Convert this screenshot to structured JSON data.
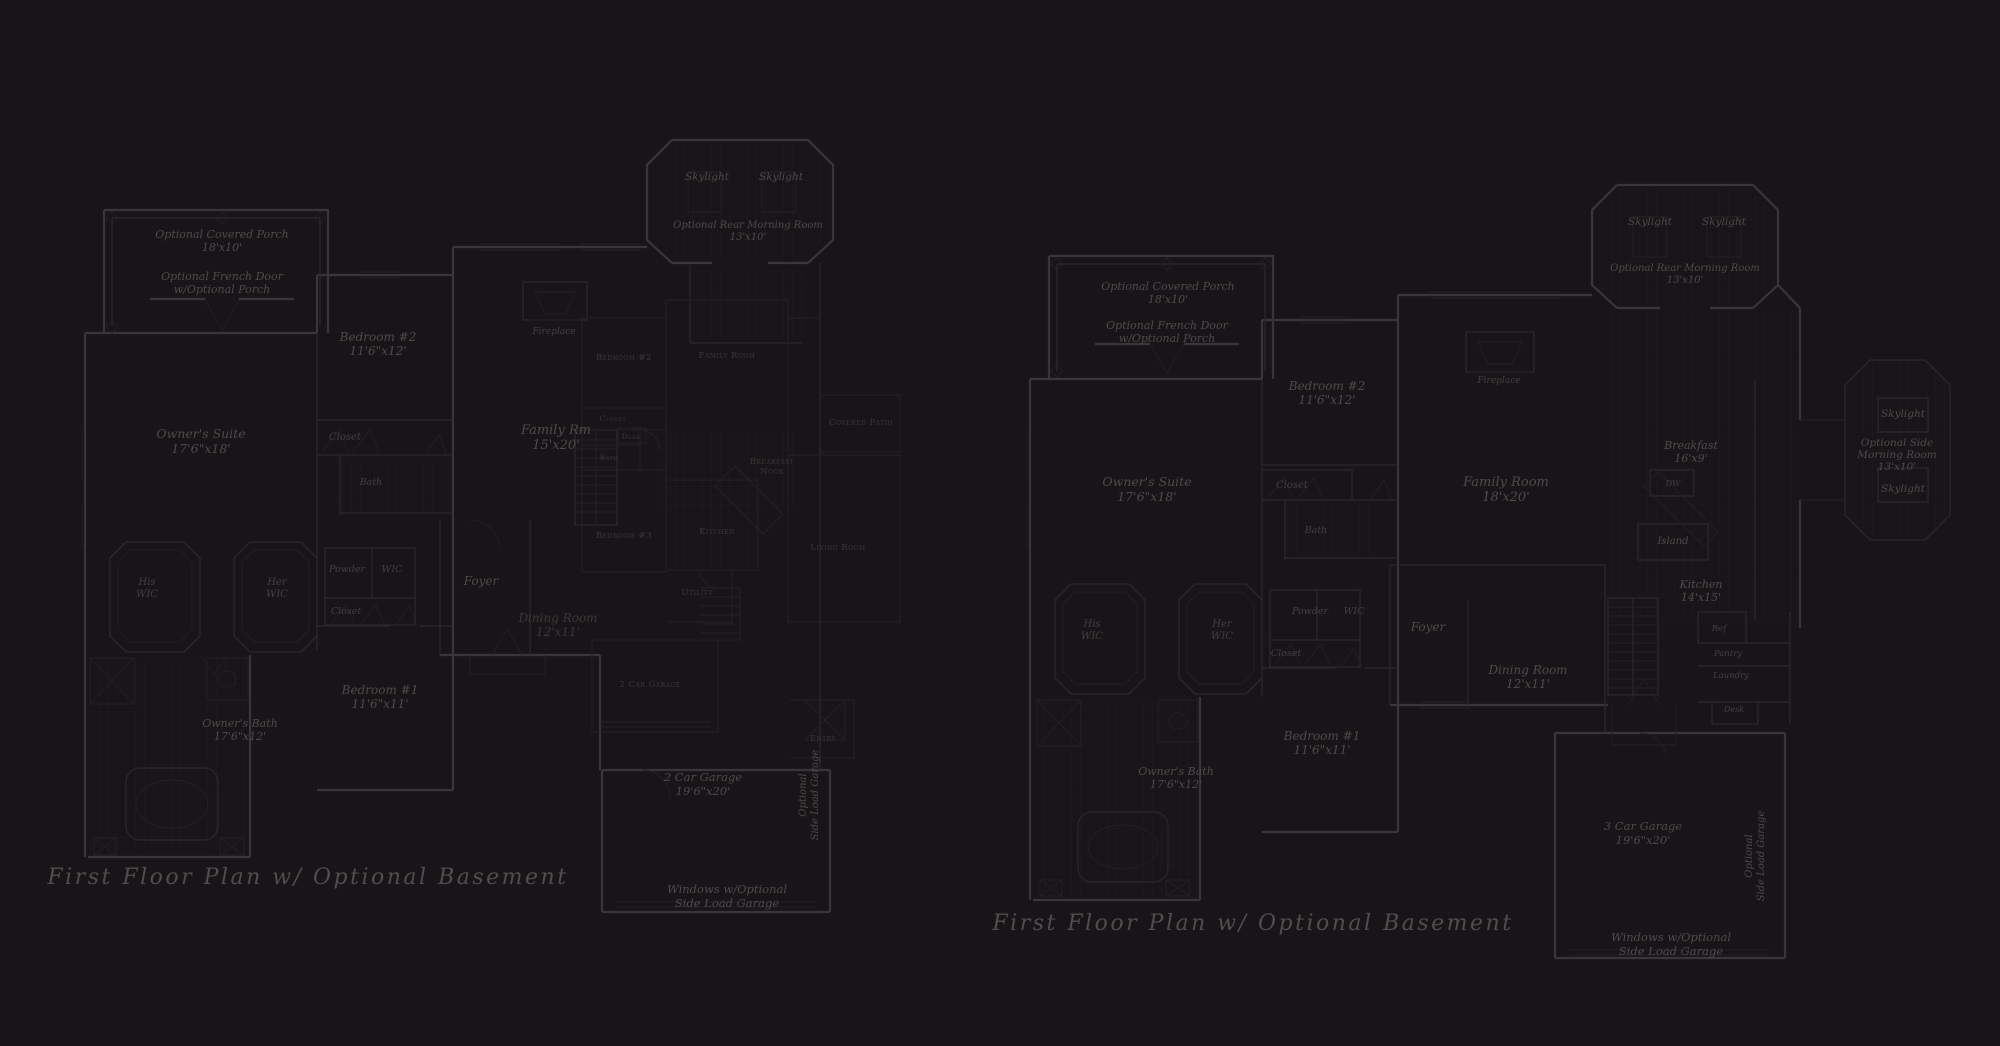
{
  "palette": {
    "background": "#181518",
    "wall_strong": "#39353a",
    "wall_medium": "#2b282c",
    "wall_thin": "#232024",
    "tile": "#201d21",
    "overlay_line": "#242124",
    "main": "#4e4a4b",
    "dim": "#443f41",
    "faint": "#3b3739",
    "caption": "#514c4d"
  },
  "captions": {
    "left": "First Floor Plan w/ Optional Basement",
    "right": "First Floor Plan w/ Optional Basement"
  },
  "labels": [
    {
      "name": "left-optional-covered-porch",
      "x": 222,
      "y": 238,
      "size": 11,
      "color": "main",
      "lines": [
        "Optional Covered Porch",
        "18'x10'"
      ]
    },
    {
      "name": "left-optional-french-door",
      "x": 222,
      "y": 280,
      "size": 11,
      "color": "main",
      "lines": [
        "Optional French Door",
        "w/Optional Porch"
      ]
    },
    {
      "name": "left-owners-suite",
      "x": 201,
      "y": 438,
      "size": 12.5,
      "color": "main",
      "lines": [
        "Owner's Suite",
        "17'6\"x18'"
      ]
    },
    {
      "name": "left-bedroom-2",
      "x": 378,
      "y": 341,
      "size": 12,
      "color": "main",
      "lines": [
        "Bedroom #2",
        "11'6\"x12'"
      ]
    },
    {
      "name": "left-closet-bedroom2",
      "x": 345,
      "y": 440,
      "size": 10,
      "color": "dim",
      "lines": [
        "Closet"
      ]
    },
    {
      "name": "left-bath",
      "x": 371,
      "y": 485,
      "size": 9.5,
      "color": "dim",
      "lines": [
        "Bath"
      ]
    },
    {
      "name": "left-his-wic",
      "x": 147,
      "y": 585,
      "size": 10,
      "color": "dim",
      "lines": [
        "His",
        "WIC"
      ]
    },
    {
      "name": "left-her-wic",
      "x": 277,
      "y": 585,
      "size": 10,
      "color": "dim",
      "lines": [
        "Her",
        "WIC"
      ]
    },
    {
      "name": "left-powder",
      "x": 347,
      "y": 572,
      "size": 9.5,
      "color": "dim",
      "lines": [
        "Powder"
      ]
    },
    {
      "name": "left-wic",
      "x": 392,
      "y": 572,
      "size": 9.5,
      "color": "dim",
      "lines": [
        "WIC"
      ]
    },
    {
      "name": "left-closet-hall",
      "x": 346,
      "y": 614,
      "size": 9.5,
      "color": "dim",
      "lines": [
        "Closet"
      ]
    },
    {
      "name": "left-bedroom-1",
      "x": 380,
      "y": 694,
      "size": 12,
      "color": "main",
      "lines": [
        "Bedroom #1",
        "11'6\"x11'"
      ]
    },
    {
      "name": "left-owners-bath",
      "x": 240,
      "y": 727,
      "size": 11,
      "color": "main",
      "lines": [
        "Owner's Bath",
        "17'6\"x12'"
      ]
    },
    {
      "name": "left-family-rm",
      "x": 556,
      "y": 434,
      "size": 13,
      "color": "main",
      "lines": [
        "Family Rm",
        "15'x20'"
      ]
    },
    {
      "name": "left-foyer",
      "x": 481,
      "y": 585,
      "size": 12,
      "color": "main",
      "lines": [
        "Foyer"
      ]
    },
    {
      "name": "left-dining",
      "x": 558,
      "y": 622,
      "size": 12,
      "color": "faint",
      "lines": [
        "Dining Room",
        "12'x11'"
      ]
    },
    {
      "name": "left-skylight-1",
      "x": 707,
      "y": 180,
      "size": 10.5,
      "color": "main",
      "lines": [
        "Skylight"
      ]
    },
    {
      "name": "left-skylight-2",
      "x": 781,
      "y": 180,
      "size": 10.5,
      "color": "main",
      "lines": [
        "Skylight"
      ]
    },
    {
      "name": "left-rear-morning-room",
      "x": 748,
      "y": 228,
      "size": 10,
      "color": "main",
      "lines": [
        "Optional Rear Morning Room",
        "13'x10'"
      ]
    },
    {
      "name": "left-fireplace",
      "x": 554,
      "y": 334,
      "size": 9,
      "color": "dim",
      "lines": [
        "Fireplace"
      ]
    },
    {
      "name": "left-2-car-garage",
      "x": 703,
      "y": 781,
      "size": 11.5,
      "color": "main",
      "lines": [
        "2 Car Garage",
        "19'6\"x20'"
      ]
    },
    {
      "name": "left-optional-side-load-garage",
      "x": 806,
      "y": 795,
      "size": 10,
      "color": "main",
      "rotate": -90,
      "lines": [
        "Optional",
        "Side Load Garage"
      ]
    },
    {
      "name": "left-windows-side-load",
      "x": 727,
      "y": 893,
      "size": 11.5,
      "color": "main",
      "lines": [
        "Windows w/Optional",
        "Side Load Garage"
      ]
    },
    {
      "name": "left-caption",
      "x": 308,
      "y": 884,
      "size": 22,
      "color": "caption",
      "cap": true,
      "lines": [
        "First Floor Plan w/ Optional Basement"
      ]
    },
    {
      "name": "overlay-bedroom-2",
      "x": 624,
      "y": 360,
      "size": 8.5,
      "color": "faint",
      "sc": true,
      "lines": [
        "Bedroom #2"
      ]
    },
    {
      "name": "overlay-family-room",
      "x": 727,
      "y": 358,
      "size": 8.5,
      "color": "faint",
      "sc": true,
      "lines": [
        "Family Room"
      ]
    },
    {
      "name": "overlay-closet",
      "x": 613,
      "y": 421,
      "size": 7.5,
      "color": "faint",
      "sc": true,
      "lines": [
        "Closet"
      ]
    },
    {
      "name": "overlay-desk",
      "x": 631,
      "y": 439,
      "size": 7.5,
      "color": "faint",
      "sc": true,
      "lines": [
        "Desk"
      ]
    },
    {
      "name": "overlay-bath",
      "x": 609,
      "y": 460,
      "size": 7.5,
      "color": "faint",
      "sc": true,
      "lines": [
        "Bath"
      ]
    },
    {
      "name": "overlay-bedroom-3",
      "x": 624,
      "y": 538,
      "size": 8.5,
      "color": "faint",
      "sc": true,
      "lines": [
        "Bedroom #3"
      ]
    },
    {
      "name": "overlay-breakfast-nook",
      "x": 772,
      "y": 464,
      "size": 8.5,
      "color": "faint",
      "sc": true,
      "lines": [
        "Breakfast",
        "Nook"
      ]
    },
    {
      "name": "overlay-kitchen",
      "x": 717,
      "y": 534,
      "size": 8.5,
      "color": "faint",
      "sc": true,
      "lines": [
        "Kitchen"
      ]
    },
    {
      "name": "overlay-living-room",
      "x": 838,
      "y": 550,
      "size": 8.5,
      "color": "faint",
      "sc": true,
      "lines": [
        "Living Room"
      ]
    },
    {
      "name": "overlay-covered-patio",
      "x": 861,
      "y": 425,
      "size": 8.5,
      "color": "faint",
      "sc": true,
      "lines": [
        "Covered Patio"
      ]
    },
    {
      "name": "overlay-utility",
      "x": 697,
      "y": 595,
      "size": 8.5,
      "color": "faint",
      "sc": true,
      "lines": [
        "Utility"
      ]
    },
    {
      "name": "overlay-2-car-garage",
      "x": 650,
      "y": 687,
      "size": 8.5,
      "color": "faint",
      "sc": true,
      "lines": [
        "2 Car Garage"
      ]
    },
    {
      "name": "overlay-entry",
      "x": 823,
      "y": 741,
      "size": 8,
      "color": "faint",
      "sc": true,
      "lines": [
        "Entry"
      ]
    },
    {
      "name": "right-optional-covered-porch",
      "x": 1168,
      "y": 290,
      "size": 11,
      "color": "main",
      "lines": [
        "Optional Covered Porch",
        "18'x10'"
      ]
    },
    {
      "name": "right-optional-french-door",
      "x": 1167,
      "y": 329,
      "size": 11,
      "color": "main",
      "lines": [
        "Optional French Door",
        "w/Optional Porch"
      ]
    },
    {
      "name": "right-owners-suite",
      "x": 1147,
      "y": 486,
      "size": 12.5,
      "color": "main",
      "lines": [
        "Owner's Suite",
        "17'6\"x18'"
      ]
    },
    {
      "name": "right-bedroom-2",
      "x": 1327,
      "y": 390,
      "size": 12,
      "color": "main",
      "lines": [
        "Bedroom #2",
        "11'6\"x12'"
      ]
    },
    {
      "name": "right-closet-bedroom2",
      "x": 1292,
      "y": 488,
      "size": 10,
      "color": "dim",
      "lines": [
        "Closet"
      ]
    },
    {
      "name": "right-bath",
      "x": 1316,
      "y": 533,
      "size": 9.5,
      "color": "dim",
      "lines": [
        "Bath"
      ]
    },
    {
      "name": "right-his-wic",
      "x": 1092,
      "y": 627,
      "size": 10,
      "color": "dim",
      "lines": [
        "His",
        "WIC"
      ]
    },
    {
      "name": "right-her-wic",
      "x": 1222,
      "y": 627,
      "size": 10,
      "color": "dim",
      "lines": [
        "Her",
        "WIC"
      ]
    },
    {
      "name": "right-powder",
      "x": 1310,
      "y": 614,
      "size": 9.5,
      "color": "dim",
      "lines": [
        "Powder"
      ]
    },
    {
      "name": "right-wic",
      "x": 1354,
      "y": 614,
      "size": 9.5,
      "color": "dim",
      "lines": [
        "WIC"
      ]
    },
    {
      "name": "right-closet-hall",
      "x": 1286,
      "y": 656,
      "size": 9.5,
      "color": "dim",
      "lines": [
        "Closet"
      ]
    },
    {
      "name": "right-bedroom-1",
      "x": 1322,
      "y": 740,
      "size": 12,
      "color": "main",
      "lines": [
        "Bedroom #1",
        "11'6\"x11'"
      ]
    },
    {
      "name": "right-owners-bath",
      "x": 1176,
      "y": 775,
      "size": 11,
      "color": "main",
      "lines": [
        "Owner's Bath",
        "17'6\"x12'"
      ]
    },
    {
      "name": "right-family-room",
      "x": 1506,
      "y": 486,
      "size": 13,
      "color": "main",
      "lines": [
        "Family Room",
        "18'x20'"
      ]
    },
    {
      "name": "right-fireplace",
      "x": 1499,
      "y": 383,
      "size": 9,
      "color": "dim",
      "lines": [
        "Fireplace"
      ]
    },
    {
      "name": "right-foyer",
      "x": 1428,
      "y": 631,
      "size": 12,
      "color": "main",
      "lines": [
        "Foyer"
      ]
    },
    {
      "name": "right-dining-room",
      "x": 1528,
      "y": 674,
      "size": 12,
      "color": "main",
      "lines": [
        "Dining Room",
        "12'x11'"
      ]
    },
    {
      "name": "right-breakfast",
      "x": 1691,
      "y": 449,
      "size": 11,
      "color": "main",
      "lines": [
        "Breakfast",
        "16'x9'"
      ]
    },
    {
      "name": "right-dw",
      "x": 1673,
      "y": 486,
      "size": 8,
      "color": "dim",
      "lines": [
        "DW"
      ]
    },
    {
      "name": "right-island",
      "x": 1673,
      "y": 544,
      "size": 10,
      "color": "main",
      "lines": [
        "Island"
      ]
    },
    {
      "name": "right-kitchen",
      "x": 1701,
      "y": 588,
      "size": 11,
      "color": "main",
      "lines": [
        "Kitchen",
        "14'x15'"
      ]
    },
    {
      "name": "right-ref",
      "x": 1719,
      "y": 631,
      "size": 8.5,
      "color": "dim",
      "lines": [
        "Ref"
      ]
    },
    {
      "name": "right-pantry",
      "x": 1728,
      "y": 656,
      "size": 8.5,
      "color": "dim",
      "lines": [
        "Pantry"
      ]
    },
    {
      "name": "right-laundry",
      "x": 1731,
      "y": 678,
      "size": 8.5,
      "color": "dim",
      "lines": [
        "Laundry"
      ]
    },
    {
      "name": "right-desk",
      "x": 1734,
      "y": 712,
      "size": 8,
      "color": "dim",
      "lines": [
        "Desk"
      ]
    },
    {
      "name": "right-skylight-1",
      "x": 1650,
      "y": 225,
      "size": 10.5,
      "color": "main",
      "lines": [
        "Skylight"
      ]
    },
    {
      "name": "right-skylight-2",
      "x": 1724,
      "y": 225,
      "size": 10.5,
      "color": "main",
      "lines": [
        "Skylight"
      ]
    },
    {
      "name": "right-rear-morning-room",
      "x": 1685,
      "y": 271,
      "size": 10,
      "color": "main",
      "lines": [
        "Optional Rear Morning Room",
        "13'x10'"
      ]
    },
    {
      "name": "right-side-skylight-top",
      "x": 1903,
      "y": 417,
      "size": 10.5,
      "color": "main",
      "lines": [
        "Skylight"
      ]
    },
    {
      "name": "right-side-morning-room",
      "x": 1897,
      "y": 446,
      "size": 10.5,
      "color": "main",
      "lines": [
        "Optional Side",
        "Morning Room",
        "13'x10'"
      ]
    },
    {
      "name": "right-side-skylight-bottom",
      "x": 1903,
      "y": 492,
      "size": 10.5,
      "color": "main",
      "lines": [
        "Skylight"
      ]
    },
    {
      "name": "right-3-car-garage",
      "x": 1643,
      "y": 830,
      "size": 11.5,
      "color": "main",
      "lines": [
        "3 Car Garage",
        "19'6\"x20'"
      ]
    },
    {
      "name": "right-optional-side-load-garage",
      "x": 1752,
      "y": 856,
      "size": 10,
      "color": "main",
      "rotate": -90,
      "lines": [
        "Optional",
        "Side Load Garage"
      ]
    },
    {
      "name": "right-windows-side-load",
      "x": 1671,
      "y": 941,
      "size": 11.5,
      "color": "main",
      "lines": [
        "Windows w/Optional",
        "Side Load Garage"
      ]
    },
    {
      "name": "right-caption",
      "x": 1253,
      "y": 930,
      "size": 22,
      "color": "caption",
      "cap": true,
      "lines": [
        "First Floor Plan w/ Optional Basement"
      ]
    }
  ]
}
